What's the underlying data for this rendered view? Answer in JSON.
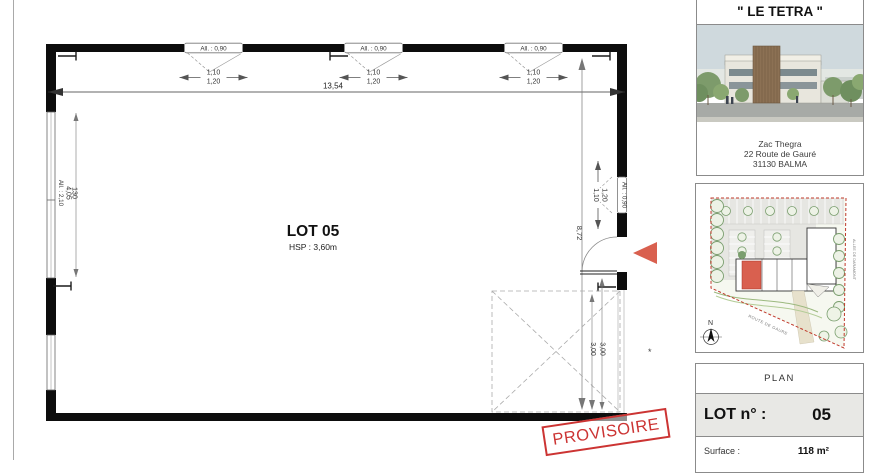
{
  "plan": {
    "lot_title": "LOT 05",
    "hsp": "HSP : 3,60m",
    "window_label": "All. : 0,90",
    "win_dim_top": "1,10",
    "win_dim_bottom": "1,20",
    "total_width": "13,54",
    "total_height": "8,72",
    "left_dim_a": "4,05",
    "left_dim_b": "130",
    "left_window_label": "All. : 2,10",
    "prov_dim_a": "3,00",
    "prov_dim_b": "3,00",
    "asterisk": "*",
    "stamp": "PROVISOIRE"
  },
  "sidebar": {
    "title": "\" LE TETRA \"",
    "address_line1": "Zac Thegra",
    "address_line2": "22 Route de Gauré",
    "address_line3": "31130 BALMA",
    "map": {
      "street_label": "ROUTE DE GAURE",
      "alley_label": "ALLEE DE DARAMONT",
      "north_label": "N"
    },
    "titleblock": {
      "plan_label": "PLAN",
      "lot_label": "LOT n° :",
      "lot_value": "05",
      "surface_label": "Surface :",
      "surface_value": "118 m²"
    }
  },
  "colors": {
    "stamp_red": "#cc3433",
    "entry_arrow": "#d9604f",
    "map_highlight": "#d9604f",
    "map_boundary": "#c0392b",
    "wall_black": "#0d0d0d"
  }
}
